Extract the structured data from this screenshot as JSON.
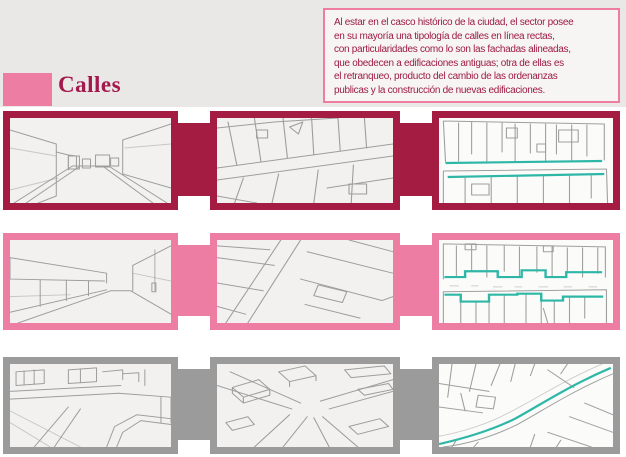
{
  "page": {
    "background": "#ffffff",
    "header_background": "#e9e8e7"
  },
  "title": {
    "label": "Calles",
    "color": "#a3184d",
    "square_color": "#ee7da4"
  },
  "intro_box": {
    "border_color": "#ee7da4",
    "background": "#f6f5f4",
    "text_color": "#9d1b40",
    "lines": [
      "Al estar en el casco histórico de la ciudad, el sector posee",
      "en su mayoría una tipología de calles en línea rectas,",
      "con particularidades como lo son las fachadas alineadas,",
      "que obedecen a edificaciones antiguas; otra de ellas es",
      "el retranqueo, producto del cambio de las ordenanzas",
      "publicas y la construcción de nuevas edificaciones."
    ]
  },
  "palette": {
    "crimson": "#a41c42",
    "pink": "#ee7da4",
    "gray": "#9b9b9b",
    "teal": "#2eb7a7",
    "sketch_ink": "#8f8f8f"
  },
  "rows": [
    {
      "name": "calles-rectas-fachadas-alineadas",
      "accent_color": "#a41c42",
      "panels": [
        {
          "name": "street-perspective-sketch"
        },
        {
          "name": "street-plan-sketch"
        },
        {
          "name": "aligned-facades-plan-with-teal-lines"
        }
      ]
    },
    {
      "name": "retranqueo",
      "accent_color": "#ee7da4",
      "panels": [
        {
          "name": "street-perspective-sketch"
        },
        {
          "name": "street-plan-sketch"
        },
        {
          "name": "setback-facades-plan-with-teal-steps"
        }
      ]
    },
    {
      "name": "interseccion",
      "accent_color": "#9b9b9b",
      "panels": [
        {
          "name": "street-perspective-sketch"
        },
        {
          "name": "intersection-axonometric-sketch"
        },
        {
          "name": "street-route-map-with-teal-path"
        }
      ]
    }
  ]
}
